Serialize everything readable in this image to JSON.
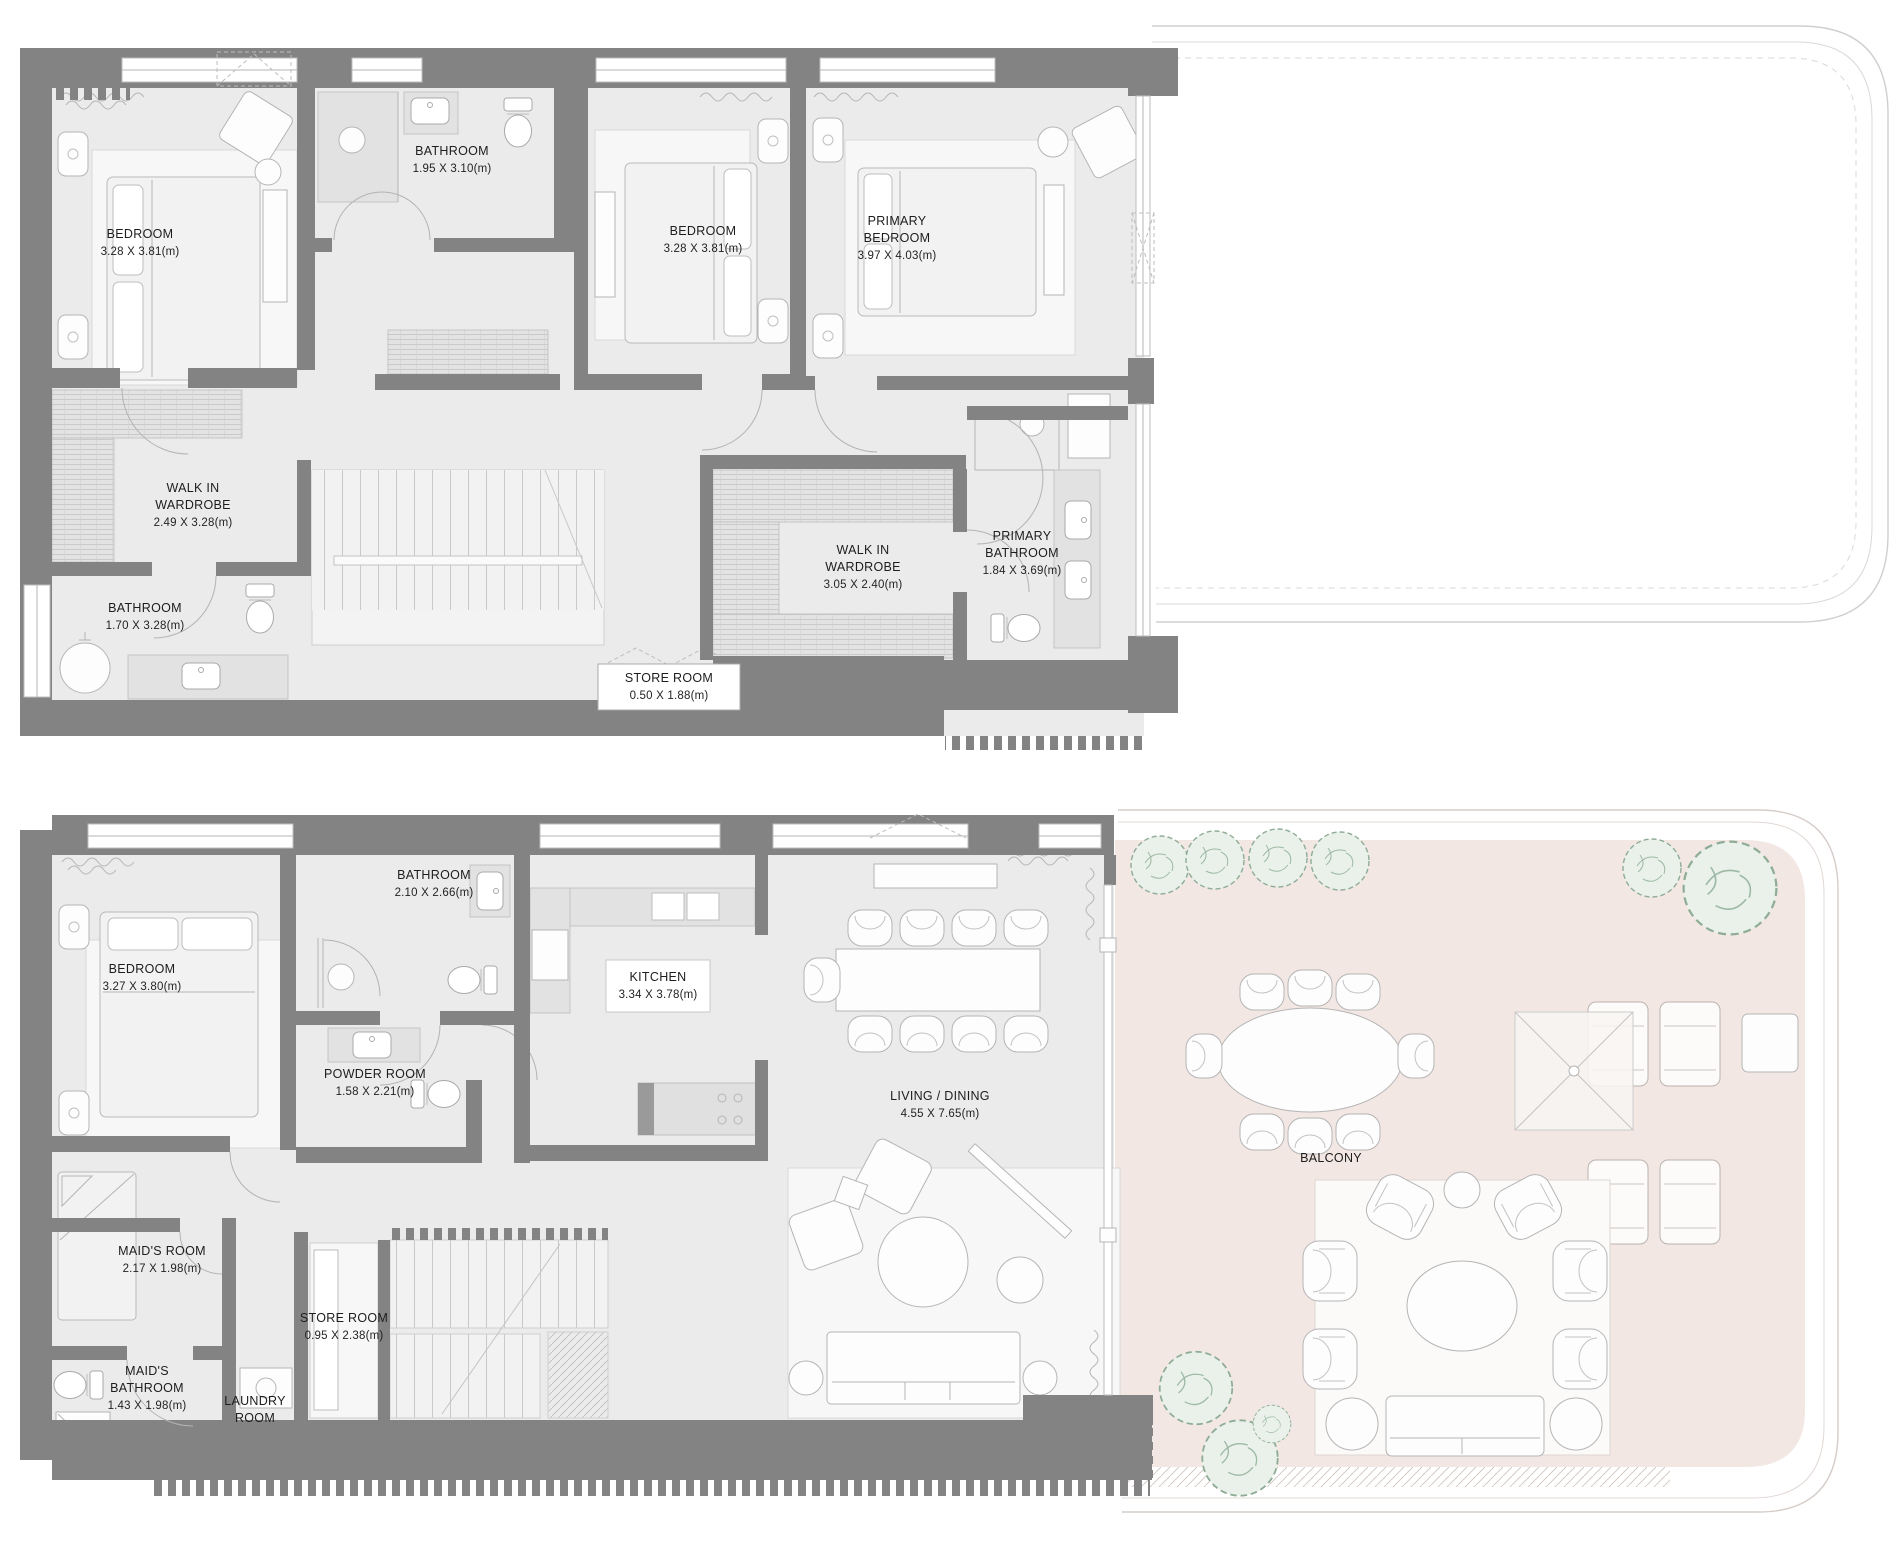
{
  "plans": {
    "upper": {
      "name": "upper-level-plan",
      "rooms": [
        {
          "id": "bedroom-1",
          "lines": [
            "BEDROOM",
            "3.28 X 3.81(m)"
          ]
        },
        {
          "id": "bathroom-1",
          "lines": [
            "BATHROOM",
            "1.95 X 3.10(m)"
          ]
        },
        {
          "id": "bedroom-2",
          "lines": [
            "BEDROOM",
            "3.28 X 3.81(m)"
          ]
        },
        {
          "id": "primary-bedroom",
          "lines": [
            "PRIMARY",
            "BEDROOM",
            "3.97 X 4.03(m)"
          ]
        },
        {
          "id": "walk-in-wardrobe-1",
          "lines": [
            "WALK IN",
            "WARDROBE",
            "2.49 X 3.28(m)"
          ]
        },
        {
          "id": "bathroom-2",
          "lines": [
            "BATHROOM",
            "1.70 X 3.28(m)"
          ]
        },
        {
          "id": "walk-in-wardrobe-2",
          "lines": [
            "WALK IN",
            "WARDROBE",
            "3.05 X 2.40(m)"
          ]
        },
        {
          "id": "primary-bathroom",
          "lines": [
            "PRIMARY",
            "BATHROOM",
            "1.84 X 3.69(m)"
          ]
        },
        {
          "id": "store-room",
          "lines": [
            "STORE ROOM",
            "0.50 X 1.88(m)"
          ]
        }
      ]
    },
    "lower": {
      "name": "lower-level-plan",
      "rooms": [
        {
          "id": "bedroom",
          "lines": [
            "BEDROOM",
            "3.27 X 3.80(m)"
          ]
        },
        {
          "id": "bathroom",
          "lines": [
            "BATHROOM",
            "2.10 X 2.66(m)"
          ]
        },
        {
          "id": "kitchen",
          "lines": [
            "KITCHEN",
            "3.34 X 3.78(m)"
          ]
        },
        {
          "id": "powder-room",
          "lines": [
            "POWDER ROOM",
            "1.58 X 2.21(m)"
          ]
        },
        {
          "id": "living-dining",
          "lines": [
            "LIVING / DINING",
            "4.55 X 7.65(m)"
          ]
        },
        {
          "id": "maids-room",
          "lines": [
            "MAID'S ROOM",
            "2.17 X 1.98(m)"
          ]
        },
        {
          "id": "store-room",
          "lines": [
            "STORE ROOM",
            "0.95 X 2.38(m)"
          ]
        },
        {
          "id": "maids-bathroom",
          "lines": [
            "MAID'S",
            "BATHROOM",
            "1.43 X 1.98(m)"
          ]
        },
        {
          "id": "laundry-room",
          "lines": [
            "LAUNDRY",
            "ROOM"
          ]
        },
        {
          "id": "balcony",
          "lines": [
            "BALCONY"
          ]
        }
      ]
    }
  },
  "colors": {
    "wall": "#838383",
    "floor": "#ebebeb",
    "balcony_floor": "#f2e7e3",
    "tree_green": "#9db9a4",
    "furniture_line": "#b5b5b5",
    "label_text": "#1d1d1d"
  },
  "icons": {
    "bed": "bed-icon",
    "toilet": "toilet-icon",
    "sink": "sink-icon",
    "bathtub": "bathtub-icon",
    "shower": "shower-icon",
    "chair": "chair-icon",
    "armchair": "armchair-icon",
    "lounger": "lounger-icon",
    "tree": "tree-icon",
    "stairs": "stairs-icon",
    "wardrobe": "wardrobe-hatch-icon"
  }
}
